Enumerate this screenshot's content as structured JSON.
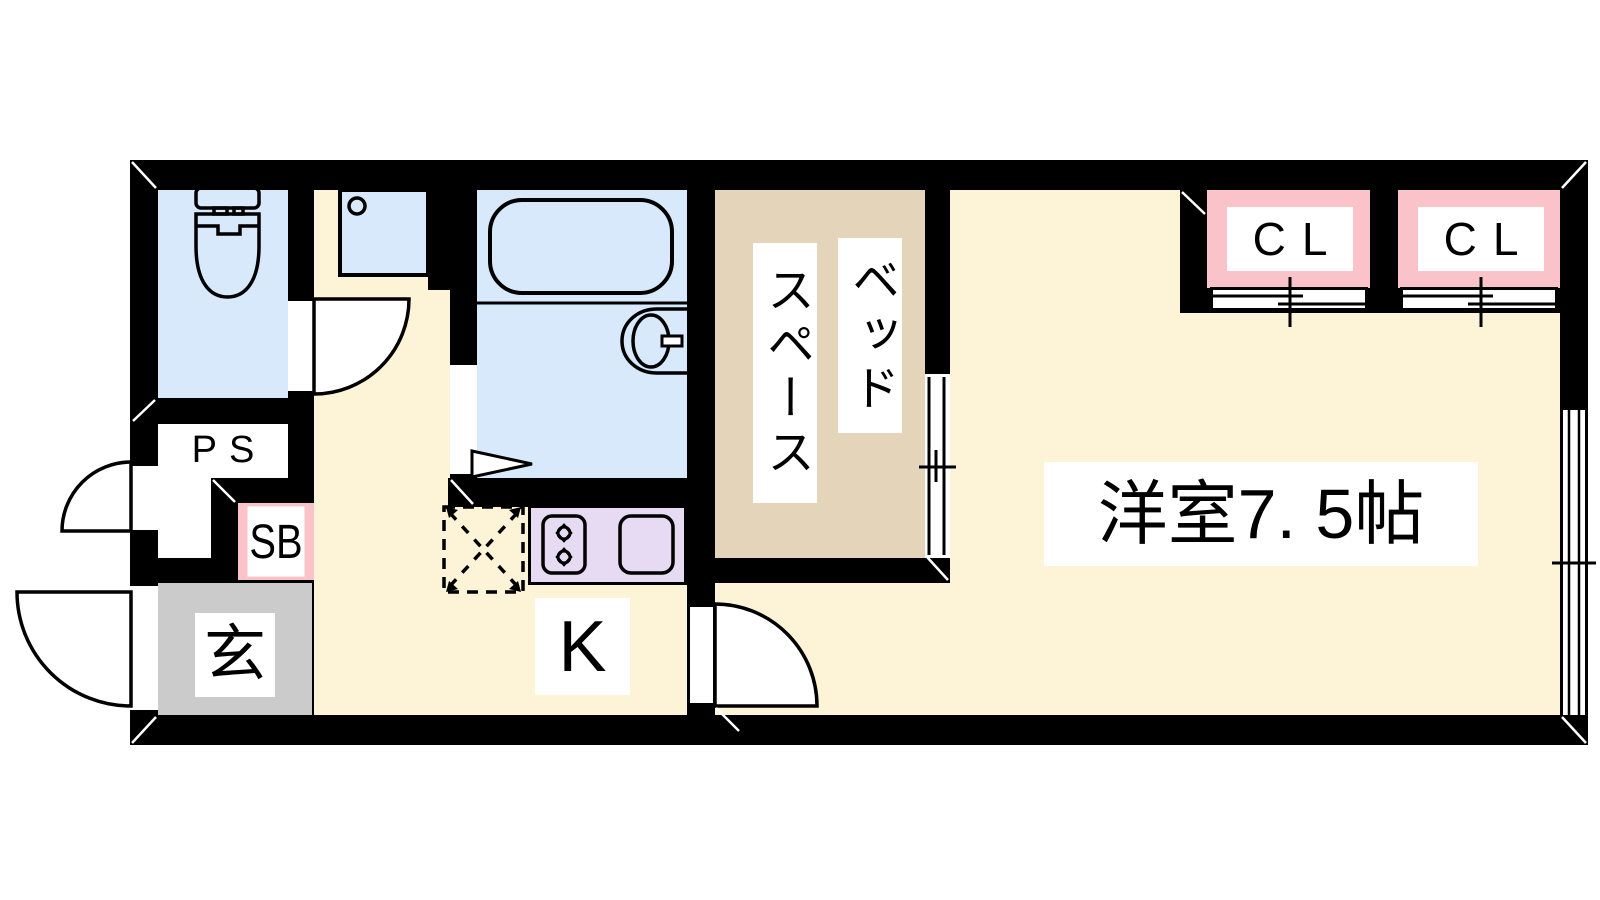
{
  "document": {
    "type": "japanese-apartment-floor-plan"
  },
  "labels": {
    "pipe_space": "PS",
    "shoe_box": "SB",
    "entrance": "玄",
    "kitchen": "K",
    "closet_left": "CL",
    "closet_right": "CL",
    "bed_space_line1": "ベッド",
    "bed_space_line2": "スペース",
    "main_room": "洋室7. 5帖"
  },
  "fixtures": [
    "toilet",
    "washbasin",
    "bathtub",
    "bathroom-sink",
    "gas-stove",
    "kitchen-sink",
    "refrigerator-space",
    "hinged-door",
    "folding-door",
    "sliding-door",
    "closet-sliding-door",
    "window"
  ],
  "colors": {
    "wall": "#000000",
    "floor_cream": "#fdf3d6",
    "wet_area_blue": "#d9e9fc",
    "bed_space_tan": "#e4d5ba",
    "closet_pink": "#f9c3c9",
    "kitchen_purple": "#e6dbf2",
    "entrance_gray": "#cbcbcb",
    "label_bg": "#ffffff"
  }
}
